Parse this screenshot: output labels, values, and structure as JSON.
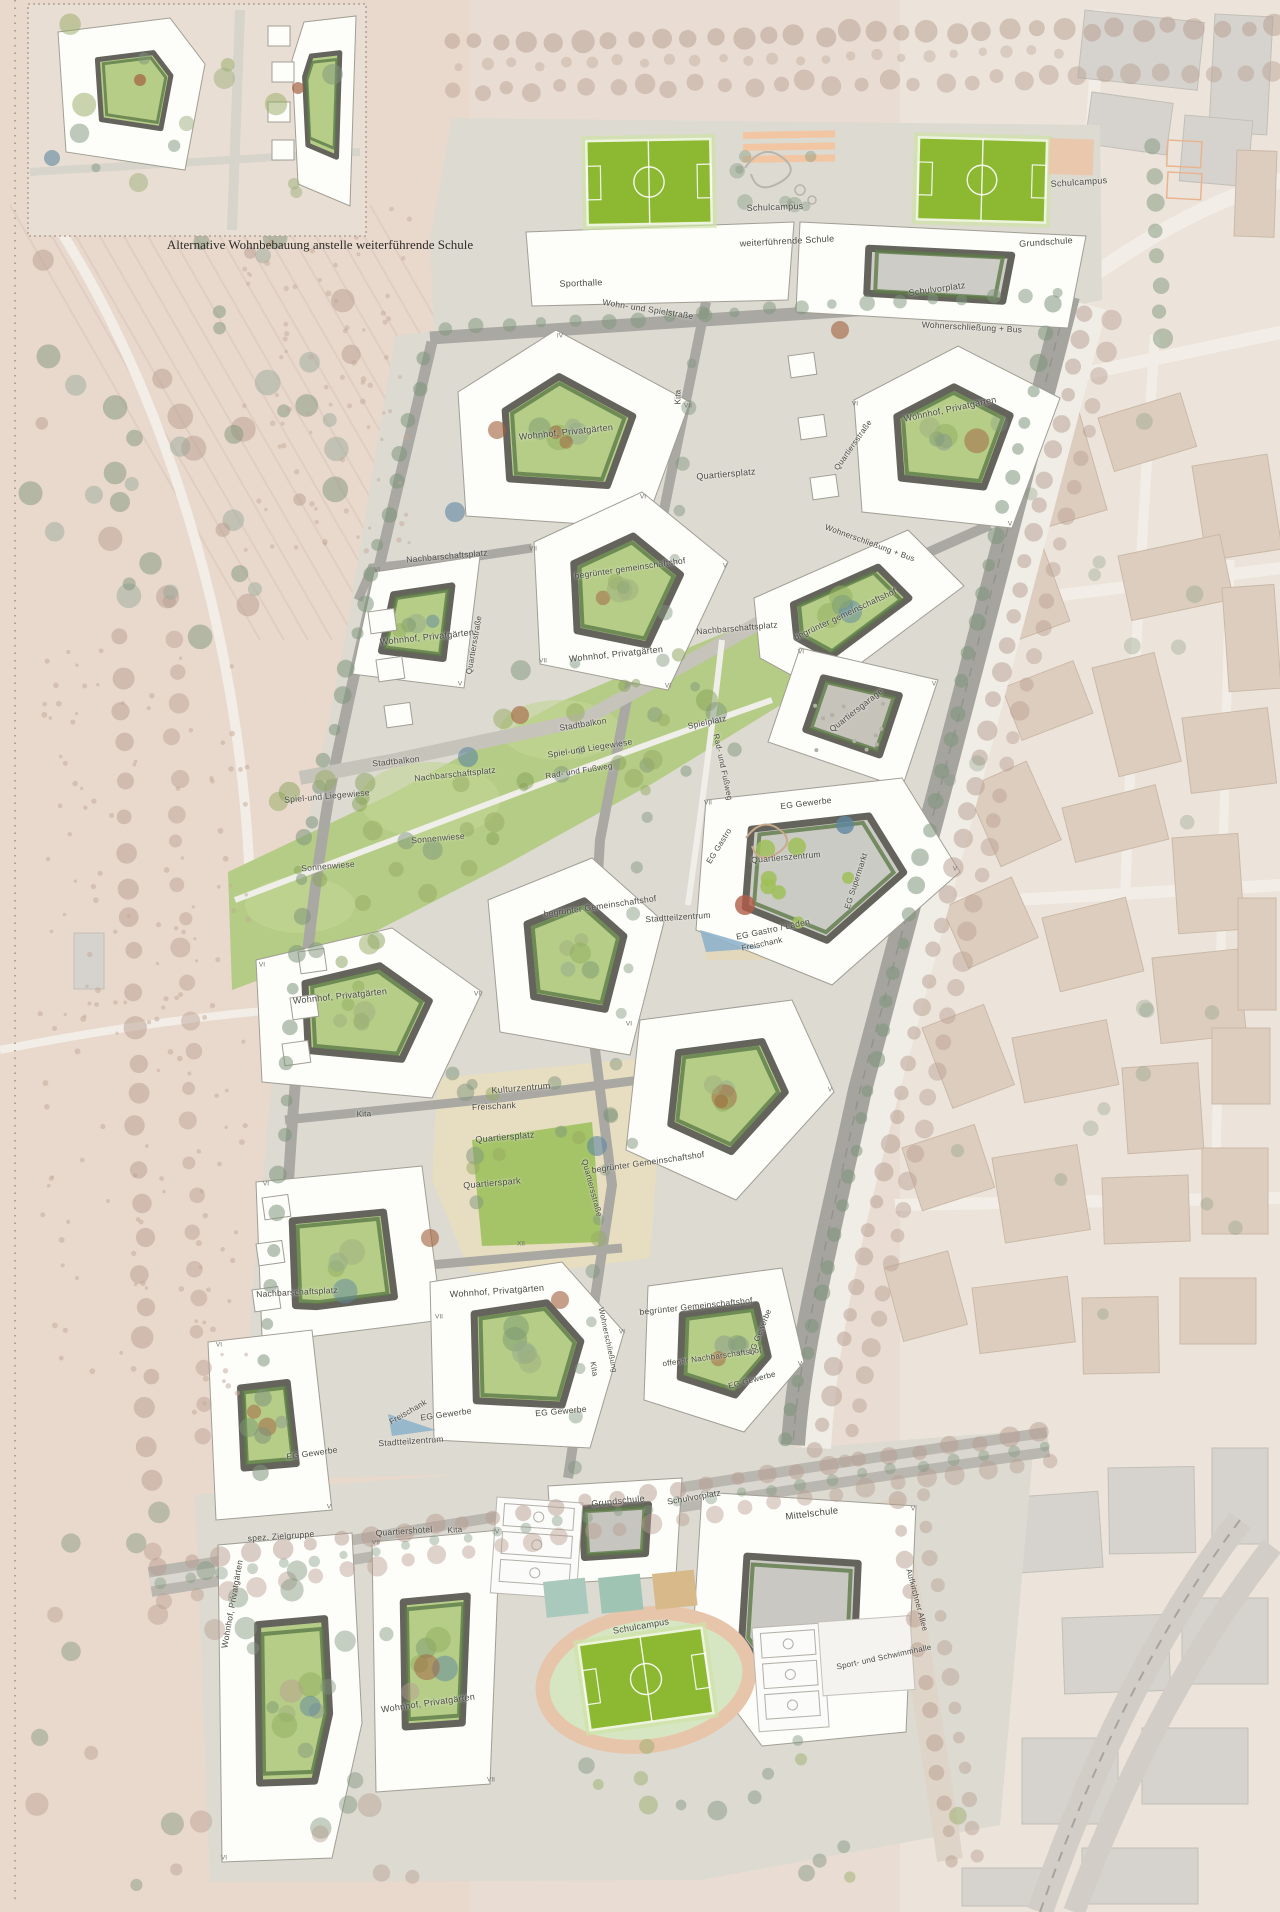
{
  "inset": {
    "caption": "Alternative Wohnbebauung anstelle weiterführende Schule"
  },
  "colors": {
    "field_green": "#8cb832",
    "courtyard_green": "#b6cd88",
    "hedge_green": "#5e7a49",
    "plaza_beige": "#e7ddc0",
    "park_green": "#a5c468",
    "meadow_green": "#b4cc85",
    "water_blue": "#8fb3ca",
    "ground_grey": "#dcdad1",
    "context_beige": "#dccdbe",
    "context_grey": "#d6d3ce",
    "accent_rust": "#a2603e",
    "accent_blue": "#5f87a0"
  },
  "labels": [
    {
      "t": "Schulcampus",
      "x": 775,
      "y": 207,
      "r": -2,
      "s": 9
    },
    {
      "t": "weiterführende Schule",
      "x": 787,
      "y": 241,
      "r": -3,
      "s": 9
    },
    {
      "t": "Schulcampus",
      "x": 1079,
      "y": 182,
      "r": -4,
      "s": 9
    },
    {
      "t": "Grundschule",
      "x": 1046,
      "y": 242,
      "r": -4,
      "s": 9
    },
    {
      "t": "Sporthalle",
      "x": 581,
      "y": 283,
      "r": -2,
      "s": 9
    },
    {
      "t": "Wohn- und Spielstraße",
      "x": 648,
      "y": 309,
      "r": 9,
      "s": 8.5
    },
    {
      "t": "Schulvorplatz",
      "x": 937,
      "y": 289,
      "r": -8,
      "s": 9
    },
    {
      "t": "Wohnerschließung + Bus",
      "x": 972,
      "y": 327,
      "r": 3,
      "s": 8.5
    },
    {
      "t": "Wohnhof, Privatgärten",
      "x": 950,
      "y": 409,
      "r": -12,
      "s": 9
    },
    {
      "t": "Kita",
      "x": 678,
      "y": 397,
      "r": -90,
      "s": 8
    },
    {
      "t": "Quartiersplatz",
      "x": 726,
      "y": 474,
      "r": -5,
      "s": 9
    },
    {
      "t": "Quartiersstraße",
      "x": 853,
      "y": 445,
      "r": -55,
      "s": 8
    },
    {
      "t": "Wohnhof, Privatgärten",
      "x": 566,
      "y": 432,
      "r": -6,
      "s": 9
    },
    {
      "t": "Wohnerschließung + Bus",
      "x": 870,
      "y": 543,
      "r": 20,
      "s": 8
    },
    {
      "t": "begrünter gemeinschaftshof",
      "x": 630,
      "y": 568,
      "r": -8,
      "s": 8.5
    },
    {
      "t": "Nachbarschaftsplatz",
      "x": 447,
      "y": 556,
      "r": -5,
      "s": 8.5
    },
    {
      "t": "begrünter gemeinschaftshof",
      "x": 845,
      "y": 614,
      "r": -25,
      "s": 8.5
    },
    {
      "t": "Wohnhof, Privatgärten",
      "x": 427,
      "y": 637,
      "r": -6,
      "s": 9
    },
    {
      "t": "Quartiersstraße",
      "x": 474,
      "y": 645,
      "r": -80,
      "s": 8
    },
    {
      "t": "Wohnhof, Privatgärten",
      "x": 616,
      "y": 654,
      "r": -6,
      "s": 9
    },
    {
      "t": "Nachbarschaftsplatz",
      "x": 737,
      "y": 628,
      "r": -5,
      "s": 8.5
    },
    {
      "t": "Quartiersgarage",
      "x": 856,
      "y": 710,
      "r": -38,
      "s": 8.5
    },
    {
      "t": "Stadtbalkon",
      "x": 583,
      "y": 724,
      "r": -9,
      "s": 8.5
    },
    {
      "t": "Spielplatz",
      "x": 707,
      "y": 722,
      "r": -12,
      "s": 8.5
    },
    {
      "t": "Spiel-und Liegewiese",
      "x": 590,
      "y": 748,
      "r": -9,
      "s": 8.5
    },
    {
      "t": "Rad- und Fußweg",
      "x": 579,
      "y": 771,
      "r": -9,
      "s": 8
    },
    {
      "t": "Rad- und Fußweg",
      "x": 723,
      "y": 767,
      "r": 78,
      "s": 8
    },
    {
      "t": "Stadtbalkon",
      "x": 396,
      "y": 761,
      "r": -6,
      "s": 8.5
    },
    {
      "t": "Nachbarschaftsplatz",
      "x": 455,
      "y": 774,
      "r": -6,
      "s": 8.5
    },
    {
      "t": "Spiel-und Liegewiese",
      "x": 327,
      "y": 796,
      "r": -5,
      "s": 8.5
    },
    {
      "t": "Sonnenwiese",
      "x": 438,
      "y": 838,
      "r": -5,
      "s": 8.5
    },
    {
      "t": "Sonnenwiese",
      "x": 328,
      "y": 866,
      "r": -5,
      "s": 8.5
    },
    {
      "t": "EG Gewerbe",
      "x": 806,
      "y": 803,
      "r": -7,
      "s": 8.5
    },
    {
      "t": "EG Gastro",
      "x": 719,
      "y": 846,
      "r": -58,
      "s": 8
    },
    {
      "t": "Quartierszentrum",
      "x": 786,
      "y": 857,
      "r": -5,
      "s": 8.5
    },
    {
      "t": "EG Supermarkt",
      "x": 856,
      "y": 881,
      "r": -72,
      "s": 8
    },
    {
      "t": "EG Gastro / Läden",
      "x": 773,
      "y": 929,
      "r": -12,
      "s": 8.5
    },
    {
      "t": "Freischank",
      "x": 762,
      "y": 944,
      "r": -12,
      "s": 8
    },
    {
      "t": "Stadtteilzentrum",
      "x": 678,
      "y": 917,
      "r": -4,
      "s": 8.5
    },
    {
      "t": "Wohnhof, Privatgärten",
      "x": 340,
      "y": 996,
      "r": -6,
      "s": 9
    },
    {
      "t": "begrünter Gemeinschaftshof",
      "x": 600,
      "y": 906,
      "r": -8,
      "s": 8.5
    },
    {
      "t": "Kita",
      "x": 364,
      "y": 1114,
      "r": -2,
      "s": 8
    },
    {
      "t": "Kulturzentrum",
      "x": 521,
      "y": 1088,
      "r": -5,
      "s": 9
    },
    {
      "t": "Freischank",
      "x": 494,
      "y": 1106,
      "r": -3,
      "s": 8.5
    },
    {
      "t": "Quartiersplatz",
      "x": 505,
      "y": 1137,
      "r": -5,
      "s": 9
    },
    {
      "t": "Quartierspark",
      "x": 492,
      "y": 1183,
      "r": -5,
      "s": 9
    },
    {
      "t": "Quartiersstraße",
      "x": 592,
      "y": 1188,
      "r": 75,
      "s": 8
    },
    {
      "t": "begrünter Gemeinschaftshof",
      "x": 648,
      "y": 1162,
      "r": -8,
      "s": 8.5
    },
    {
      "t": "Nachbarschaftsplatz",
      "x": 297,
      "y": 1292,
      "r": -3,
      "s": 8.5
    },
    {
      "t": "Wohnhof, Privatgärten",
      "x": 497,
      "y": 1291,
      "r": -4,
      "s": 9
    },
    {
      "t": "begrünter Gemeinschaftshof",
      "x": 696,
      "y": 1306,
      "r": -6,
      "s": 8.5
    },
    {
      "t": "offener Nachbarschaftshof",
      "x": 712,
      "y": 1357,
      "r": -8,
      "s": 8
    },
    {
      "t": "EG Gewerbe",
      "x": 760,
      "y": 1332,
      "r": -68,
      "s": 8
    },
    {
      "t": "EG Gewerbe",
      "x": 752,
      "y": 1380,
      "r": -15,
      "s": 8
    },
    {
      "t": "Kita",
      "x": 594,
      "y": 1369,
      "r": 80,
      "s": 8
    },
    {
      "t": "Wohnerschließung",
      "x": 608,
      "y": 1340,
      "r": 78,
      "s": 7.5
    },
    {
      "t": "EG Gewerbe",
      "x": 561,
      "y": 1411,
      "r": -5,
      "s": 8.5
    },
    {
      "t": "EG Gewerbe",
      "x": 446,
      "y": 1414,
      "r": -8,
      "s": 8.5
    },
    {
      "t": "Freischank",
      "x": 408,
      "y": 1412,
      "r": -30,
      "s": 8
    },
    {
      "t": "Stadtteilzentrum",
      "x": 411,
      "y": 1441,
      "r": -4,
      "s": 8.5
    },
    {
      "t": "EG Gewerbe",
      "x": 312,
      "y": 1453,
      "r": -8,
      "s": 8.5
    },
    {
      "t": "spez. Zielgruppe",
      "x": 281,
      "y": 1536,
      "r": -4,
      "s": 8.5
    },
    {
      "t": "Quartiershotel",
      "x": 404,
      "y": 1531,
      "r": -4,
      "s": 8.5
    },
    {
      "t": "Kita",
      "x": 455,
      "y": 1530,
      "r": -4,
      "s": 8
    },
    {
      "t": "Wohnhof, Privatgärten",
      "x": 232,
      "y": 1604,
      "r": -80,
      "s": 8.5
    },
    {
      "t": "Wohnhof, Privatgärten",
      "x": 428,
      "y": 1703,
      "r": -8,
      "s": 9
    },
    {
      "t": "Grundschule",
      "x": 618,
      "y": 1501,
      "r": -6,
      "s": 9
    },
    {
      "t": "Schulvorplatz",
      "x": 694,
      "y": 1497,
      "r": -10,
      "s": 8.5
    },
    {
      "t": "Mittelschule",
      "x": 812,
      "y": 1514,
      "r": -7,
      "s": 9.5
    },
    {
      "t": "Schulcampus",
      "x": 641,
      "y": 1626,
      "r": -10,
      "s": 9
    },
    {
      "t": "Sport- und Schwimmhalle",
      "x": 884,
      "y": 1657,
      "r": -12,
      "s": 8
    },
    {
      "t": "Aufkirchner Allee",
      "x": 917,
      "y": 1600,
      "r": 75,
      "s": 8
    }
  ],
  "storey_marks": [
    {
      "t": "IV",
      "x": 560,
      "y": 336
    },
    {
      "t": "VII",
      "x": 688,
      "y": 406
    },
    {
      "t": "VI",
      "x": 855,
      "y": 404
    },
    {
      "t": "V",
      "x": 1010,
      "y": 524
    },
    {
      "t": "VII",
      "x": 533,
      "y": 549
    },
    {
      "t": "VI",
      "x": 643,
      "y": 497
    },
    {
      "t": "V",
      "x": 725,
      "y": 566
    },
    {
      "t": "VI",
      "x": 668,
      "y": 686
    },
    {
      "t": "VII",
      "x": 543,
      "y": 661
    },
    {
      "t": "VI",
      "x": 377,
      "y": 570
    },
    {
      "t": "V",
      "x": 460,
      "y": 684
    },
    {
      "t": "VI",
      "x": 801,
      "y": 652
    },
    {
      "t": "V",
      "x": 934,
      "y": 684
    },
    {
      "t": "VII",
      "x": 708,
      "y": 803
    },
    {
      "t": "V",
      "x": 955,
      "y": 869
    },
    {
      "t": "VI",
      "x": 262,
      "y": 965
    },
    {
      "t": "VII",
      "x": 478,
      "y": 994
    },
    {
      "t": "VI",
      "x": 629,
      "y": 1024
    },
    {
      "t": "V",
      "x": 830,
      "y": 1090
    },
    {
      "t": "VI",
      "x": 266,
      "y": 1184
    },
    {
      "t": "VII",
      "x": 439,
      "y": 1317
    },
    {
      "t": "XII",
      "x": 521,
      "y": 1244
    },
    {
      "t": "VI",
      "x": 622,
      "y": 1332
    },
    {
      "t": "V",
      "x": 800,
      "y": 1364
    },
    {
      "t": "VI",
      "x": 219,
      "y": 1345
    },
    {
      "t": "V",
      "x": 329,
      "y": 1507
    },
    {
      "t": "VII",
      "x": 376,
      "y": 1543
    },
    {
      "t": "V",
      "x": 497,
      "y": 1532
    },
    {
      "t": "VI",
      "x": 224,
      "y": 1858
    },
    {
      "t": "VII",
      "x": 491,
      "y": 1780
    },
    {
      "t": "V",
      "x": 913,
      "y": 1509
    }
  ]
}
